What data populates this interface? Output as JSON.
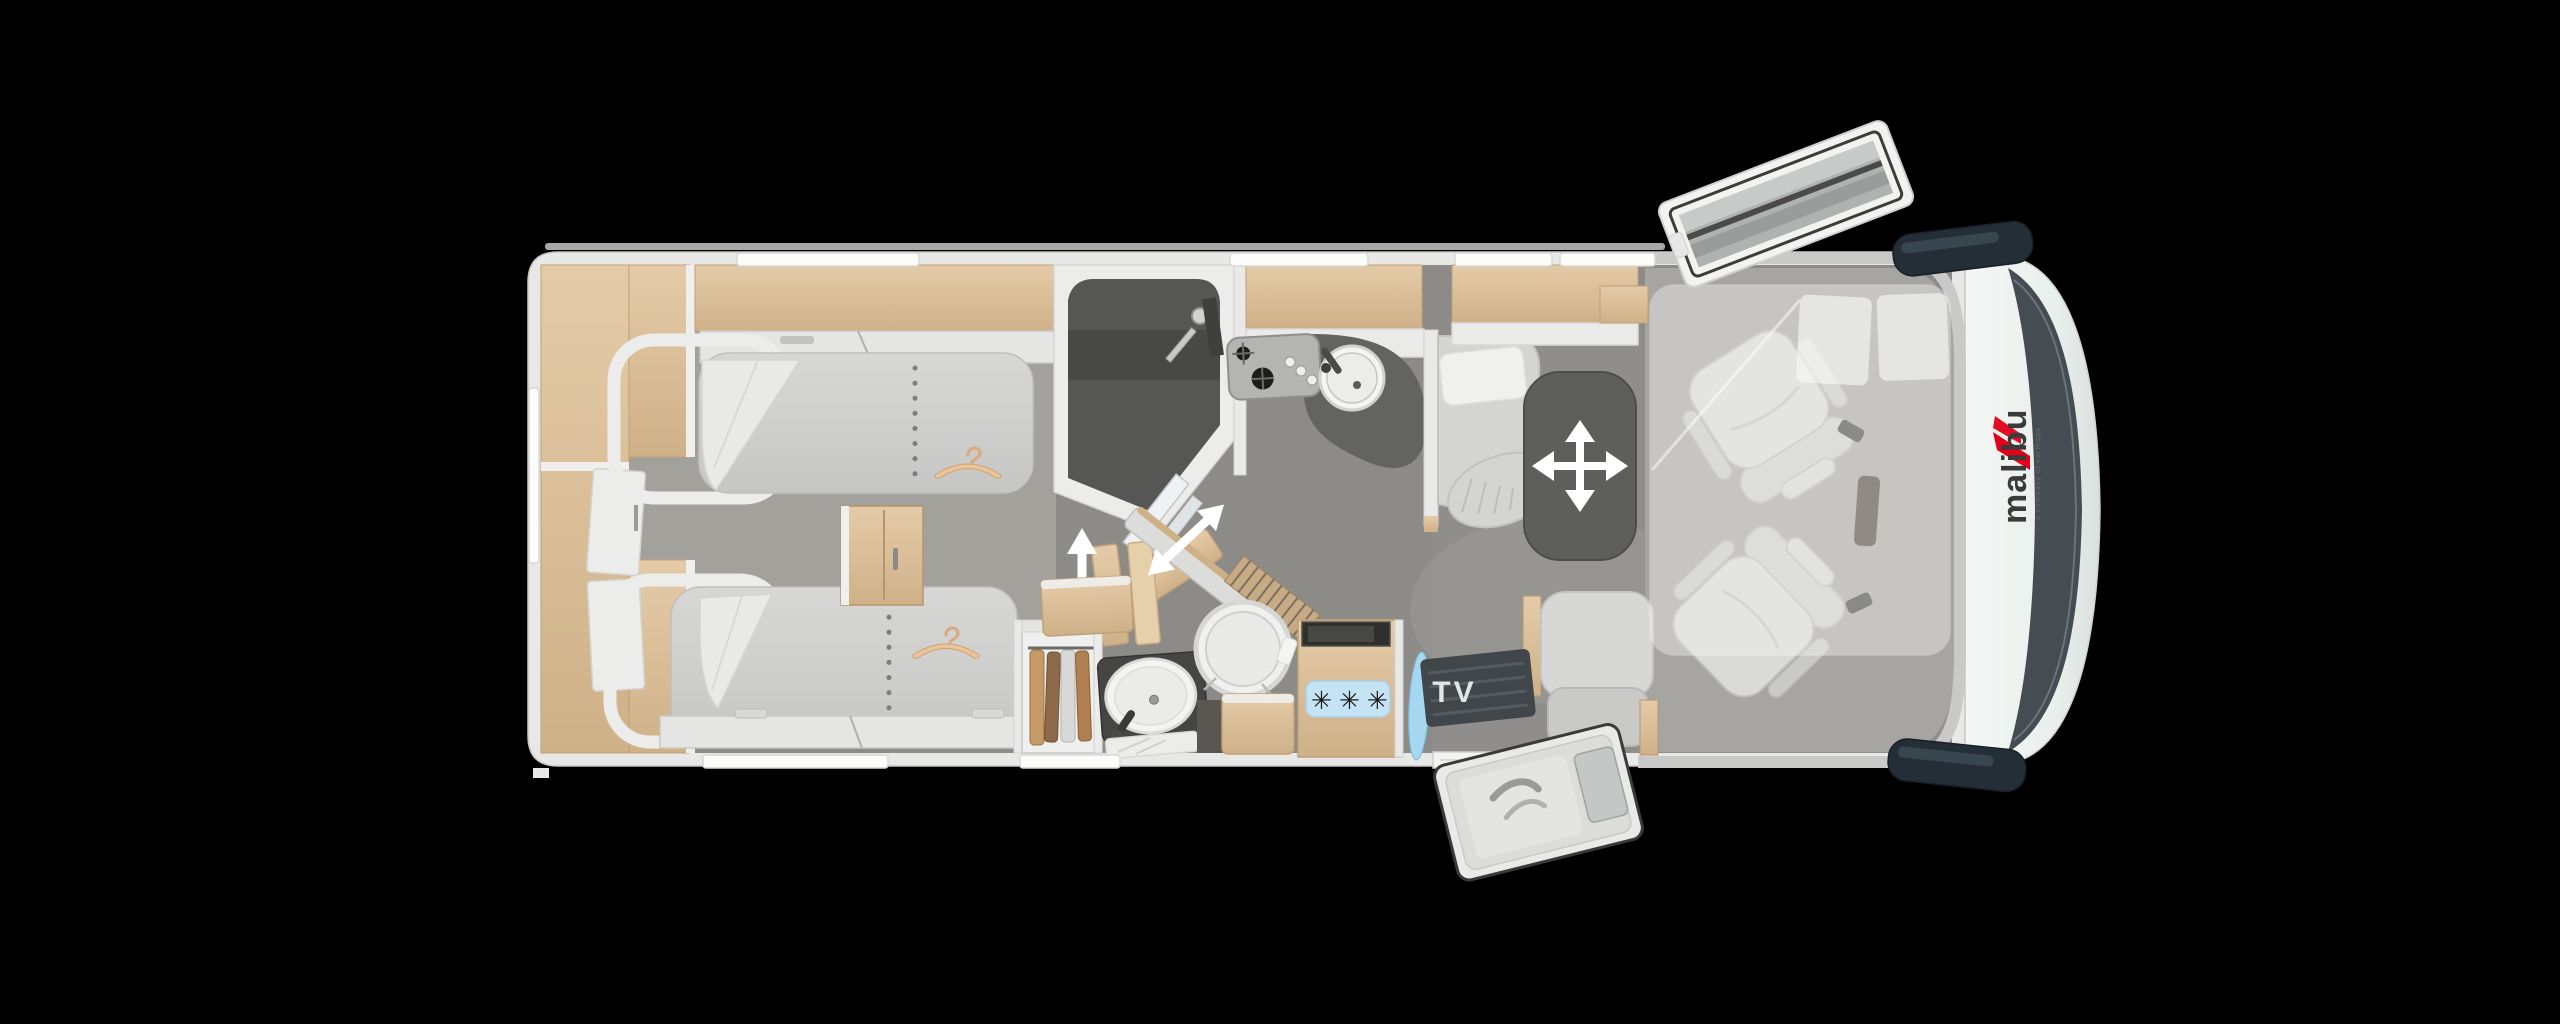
{
  "scene": {
    "background_color": "#000000",
    "description": "Top-down floor plan rendering of a Malibu motorhome with twin rear beds, bathroom, kitchen, dinette and cab seats"
  },
  "branding": {
    "logo_text": "malibu",
    "logo_tagline": "a company of carthago",
    "logo_text_color": "#3b3b3b",
    "logo_accent_color": "#e2001a"
  },
  "labels": {
    "tv": "TV",
    "freezer_class": "✳✳✳"
  },
  "icons": {
    "table_icon": "four-way-arrow",
    "partition_icon": "double-arrow",
    "door_swing_icon": "single-arrow",
    "wardrobe_icon": "clothes-hanger",
    "fridge_icon": "snowflakes",
    "roof_icon": "roof-hatch-open",
    "entry_icon": "door-open",
    "mirror_icon": "wing-mirror"
  },
  "colors": {
    "floor": "#8d8b87",
    "bedroom_floor": "#a5a39f",
    "wood": "#ddc19c",
    "wood_dark": "#b5956f",
    "upholstery": "#d6d6d4",
    "dark_surface": "#5e5e5c",
    "shower_floor": "#565654",
    "wall": "#e8e8e6",
    "cab_body": "#eff3f1",
    "windshield": "#454c52",
    "mirror": "#242e36",
    "sticker_blue": "#c4e3f5",
    "glass_blue": "#a5d7f0",
    "arrow": "#ffffff"
  }
}
